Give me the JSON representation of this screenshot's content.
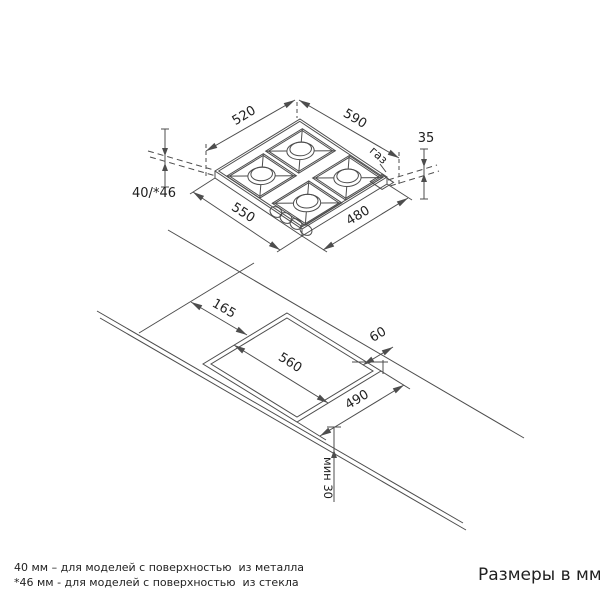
{
  "colors": {
    "line": "#4d4d4d",
    "text": "#1f1f1f",
    "background": "#ffffff"
  },
  "hob": {
    "dim_top_left": "520",
    "dim_top_right": "590",
    "dim_height_right": "35",
    "dim_height_left": "40/*46",
    "dim_bottom_left": "550",
    "dim_bottom_right": "480",
    "gas_label": "газ"
  },
  "cutout": {
    "dim_offset_left": "165",
    "dim_gap_back": "60",
    "dim_width": "560",
    "dim_depth": "490",
    "dim_min_front": "мин 30"
  },
  "footnotes": [
    "40 мм – для моделей с поверхностью  из металла",
    "*46 мм - для моделей с поверхностью  из стекла"
  ],
  "units_note": "Размеры в мм"
}
